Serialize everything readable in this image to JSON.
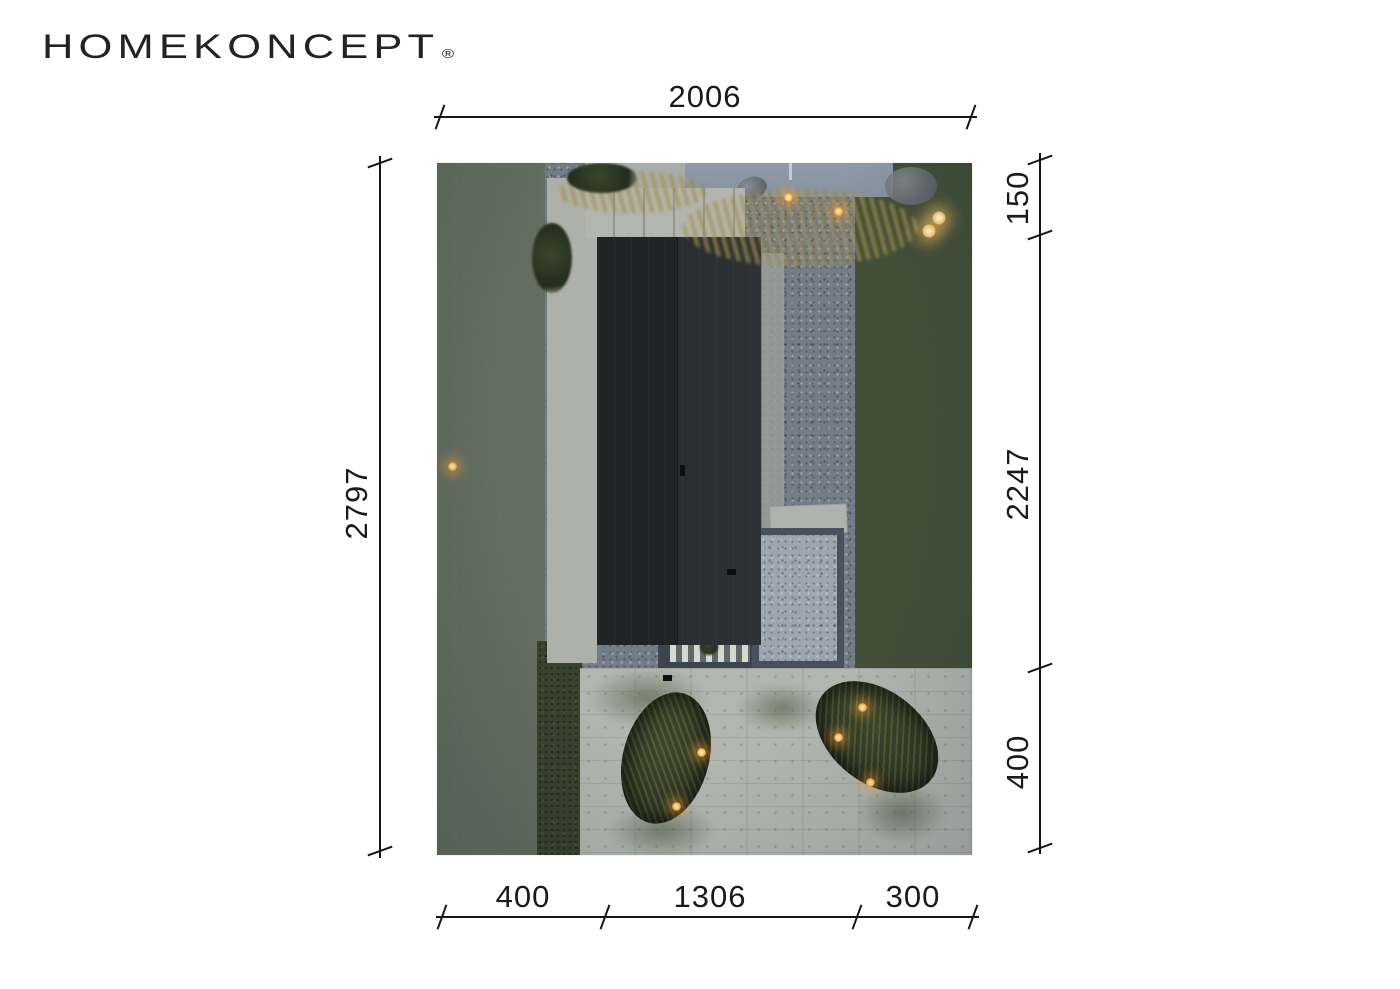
{
  "brand": {
    "logo_text": "HOMEKONCEPT",
    "registered_mark": "®"
  },
  "dimensions": {
    "top": {
      "total": "2006"
    },
    "left": {
      "total": "2797"
    },
    "right": {
      "segments": [
        {
          "label": "150"
        },
        {
          "label": "2247"
        },
        {
          "label": "400"
        }
      ]
    },
    "bottom": {
      "segments": [
        {
          "label": "400"
        },
        {
          "label": "1306"
        },
        {
          "label": "300"
        }
      ]
    }
  },
  "site_plan": {
    "type": "aerial-night-render-of-plot",
    "features": [
      "house-roof-dark",
      "front-entry-walkway",
      "side-paver-path",
      "gravel-yard",
      "lawn-left-strip",
      "lawn-right-strip",
      "street-top",
      "boulder",
      "ornamental-grasses",
      "gravel-patio-framed",
      "wood-deck-slats",
      "paved-terrace",
      "planting-island-left",
      "planting-island-right",
      "garden-lights"
    ],
    "palette": {
      "page_background": "#ffffff",
      "dimension_ink": "#161616",
      "roof_dark": "#212326",
      "roof_light": "#2e3135",
      "gravel": "#747c87",
      "grass": "#3e4834",
      "concrete": "#b2b6b1",
      "patio_frame": "#49525c",
      "street": "#8b97a4",
      "light_warm": "#f3c168"
    }
  }
}
